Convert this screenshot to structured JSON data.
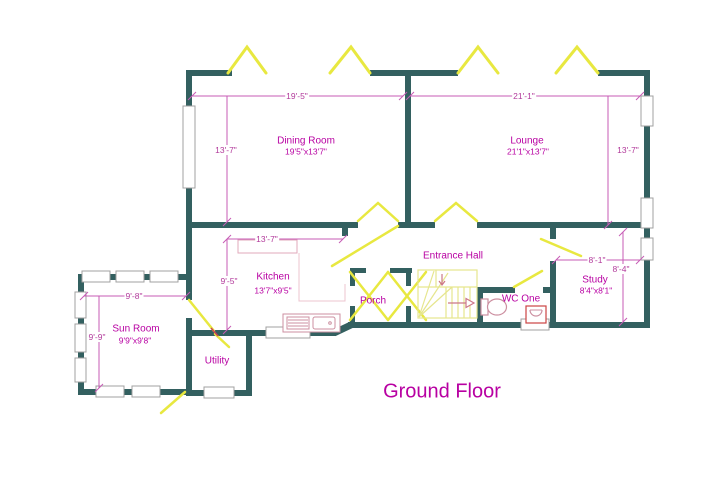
{
  "title": "Ground Floor",
  "floor_plan": {
    "rooms": [
      {
        "name": "Dining Room",
        "size": "19'5\"x13'7\""
      },
      {
        "name": "Lounge",
        "size": "21'1\"x13'7\""
      },
      {
        "name": "Entrance Hall",
        "size": ""
      },
      {
        "name": "Kitchen",
        "size": "13'7\"x9'5\""
      },
      {
        "name": "Porch",
        "size": ""
      },
      {
        "name": "WC One",
        "size": ""
      },
      {
        "name": "Study",
        "size": "8'4\"x8'1\""
      },
      {
        "name": "Sun Room",
        "size": "9'9\"x9'8\""
      },
      {
        "name": "Utility",
        "size": ""
      }
    ],
    "dimensions": [
      {
        "edge": "dining-width",
        "label": "19'-5\""
      },
      {
        "edge": "lounge-width",
        "label": "21'-1\""
      },
      {
        "edge": "dining-height",
        "label": "13'-7\""
      },
      {
        "edge": "lounge-height",
        "label": "13'-7\""
      },
      {
        "edge": "kitchen-width",
        "label": "13'-7\""
      },
      {
        "edge": "kitchen-height",
        "label": "9'-5\""
      },
      {
        "edge": "study-width",
        "label": "8'-1\""
      },
      {
        "edge": "study-height",
        "label": "8'-4\""
      },
      {
        "edge": "sunroom-width",
        "label": "9'-8\""
      },
      {
        "edge": "sunroom-height",
        "label": "9'-9\""
      }
    ],
    "colors": {
      "wall": "#336060",
      "window_door": "#e8e840",
      "room_label": "#b800a2",
      "dimension": "#b23a9b"
    }
  }
}
